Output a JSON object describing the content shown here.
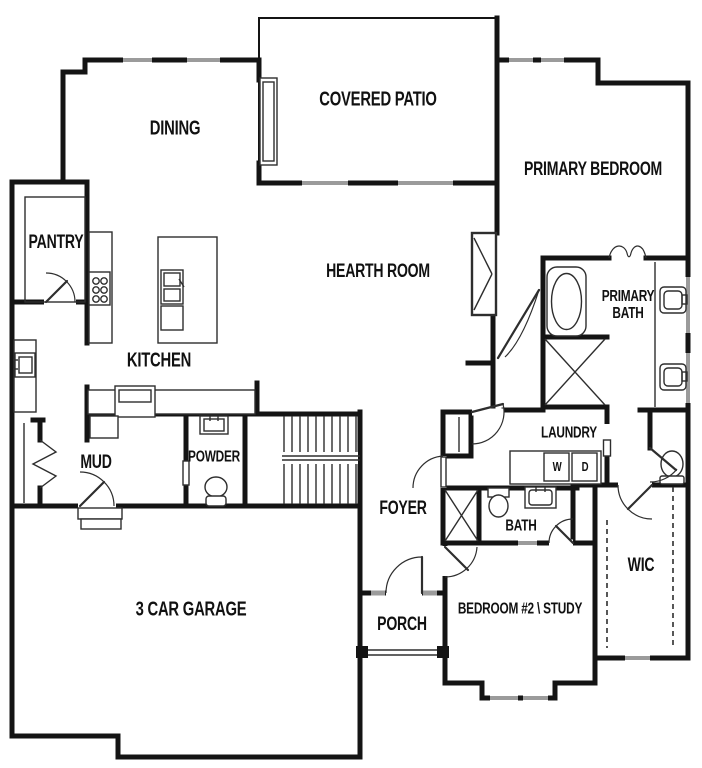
{
  "plan": {
    "colors": {
      "bg": "#ffffff",
      "wall": "#141414",
      "window": "#9b9b9b",
      "line": "#2e2e2e"
    },
    "rooms": [
      {
        "id": "covered-patio",
        "label": "COVERED PATIO"
      },
      {
        "id": "dining",
        "label": "DINING"
      },
      {
        "id": "primary-bedroom",
        "label": "PRIMARY BEDROOM"
      },
      {
        "id": "pantry",
        "label": "PANTRY"
      },
      {
        "id": "hearth-room",
        "label": "HEARTH ROOM"
      },
      {
        "id": "primary-bath",
        "label": "PRIMARY BATH"
      },
      {
        "id": "kitchen",
        "label": "KITCHEN"
      },
      {
        "id": "mud",
        "label": "MUD"
      },
      {
        "id": "powder",
        "label": "POWDER"
      },
      {
        "id": "laundry",
        "label": "LAUNDRY"
      },
      {
        "id": "foyer",
        "label": "FOYER"
      },
      {
        "id": "bath",
        "label": "BATH"
      },
      {
        "id": "wic",
        "label": "WIC"
      },
      {
        "id": "garage",
        "label": "3 CAR GARAGE"
      },
      {
        "id": "porch",
        "label": "PORCH"
      },
      {
        "id": "bedroom2",
        "label": "BEDROOM #2 \\ STUDY"
      }
    ],
    "appliances": {
      "washer": "W",
      "dryer": "D"
    }
  }
}
